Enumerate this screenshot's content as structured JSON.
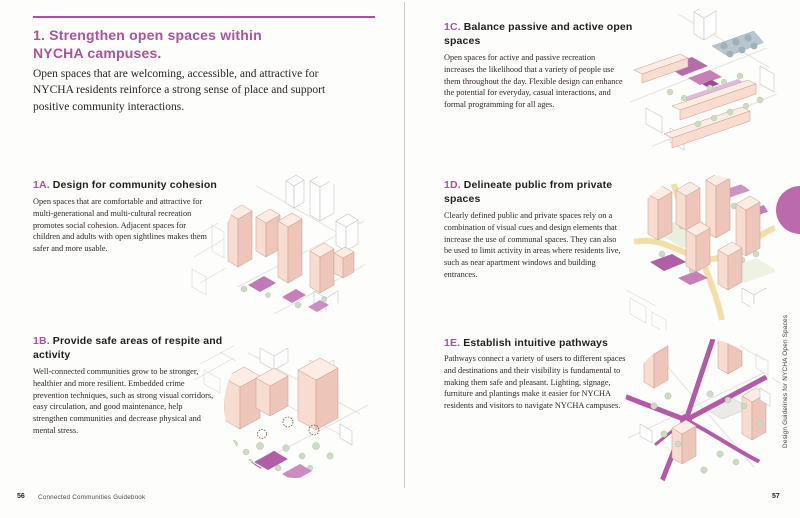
{
  "colors": {
    "accent": "#a8539c",
    "tab": "#bb6bad",
    "building_pink": "#f8dcd0",
    "plaza_magenta": "#b05ea6",
    "tree_green": "#ccdcc3",
    "path_yellow": "#f2dfa8"
  },
  "left_page": {
    "title": "1. Strengthen open spaces within NYCHA campuses.",
    "intro": "Open spaces that are welcoming, accessible, and attractive for NYCHA residents reinforce a strong sense of place and support positive community interactions.",
    "sections": [
      {
        "number": "1A.",
        "title": "Design for community cohesion",
        "body": "Open spaces that are comfortable and attractive for multi-generational and multi-cultural recreation promotes social cohesion. Adjacent spaces for children and adults with open sightlines makes them safer and more usable."
      },
      {
        "number": "1B.",
        "title": "Provide safe areas of respite and activity",
        "body": "Well-connected communities grow to be stronger, healthier and more resilient. Embedded crime prevention techniques, such as strong visual corridors, easy circulation, and good maintenance, help strengthen communities and decrease physical and mental stress."
      }
    ],
    "footer": {
      "page_number": "56",
      "book_title": "Connected Communities Guidebook"
    }
  },
  "right_page": {
    "sections": [
      {
        "number": "1C.",
        "title": "Balance passive and active open spaces",
        "body": "Open spaces for active and passive recreation increases the likelihood that a variety of people use them throughout the day. Flexible design can enhance the potential for everyday, casual interactions, and formal programming for all ages."
      },
      {
        "number": "1D.",
        "title": "Delineate public from private spaces",
        "body": "Clearly defined public and private spaces rely on a combination of visual cues and design elements that increase the use of communal spaces. They can also be used to limit activity in areas where residents live, such as near apartment windows and building entrances."
      },
      {
        "number": "1E.",
        "title": "Establish intuitive pathways",
        "body": "Pathways connect a variety of users to different spaces and destinations and their visibility is fundamental to making them safe and pleasant. Lighting, signage, furniture and plantings make it easier for NYCHA residents and visitors to navigate NYCHA campuses."
      }
    ],
    "sidebar_label": "Design Guidelines for NYCHA Open Spaces",
    "page_number": "57"
  },
  "illustrations": [
    {
      "id": "1c",
      "alt": "isometric campus with pink bar buildings, magenta courtyard, trees and grey lot"
    },
    {
      "id": "1a",
      "alt": "isometric pink towers among white line-drawn city blocks"
    },
    {
      "id": "1d",
      "alt": "isometric towers with yellow paths and magenta plazas"
    },
    {
      "id": "1b",
      "alt": "isometric towers with tree clusters and magenta plazas"
    },
    {
      "id": "1e",
      "alt": "isometric campus crossed by bold magenta pathways"
    }
  ]
}
